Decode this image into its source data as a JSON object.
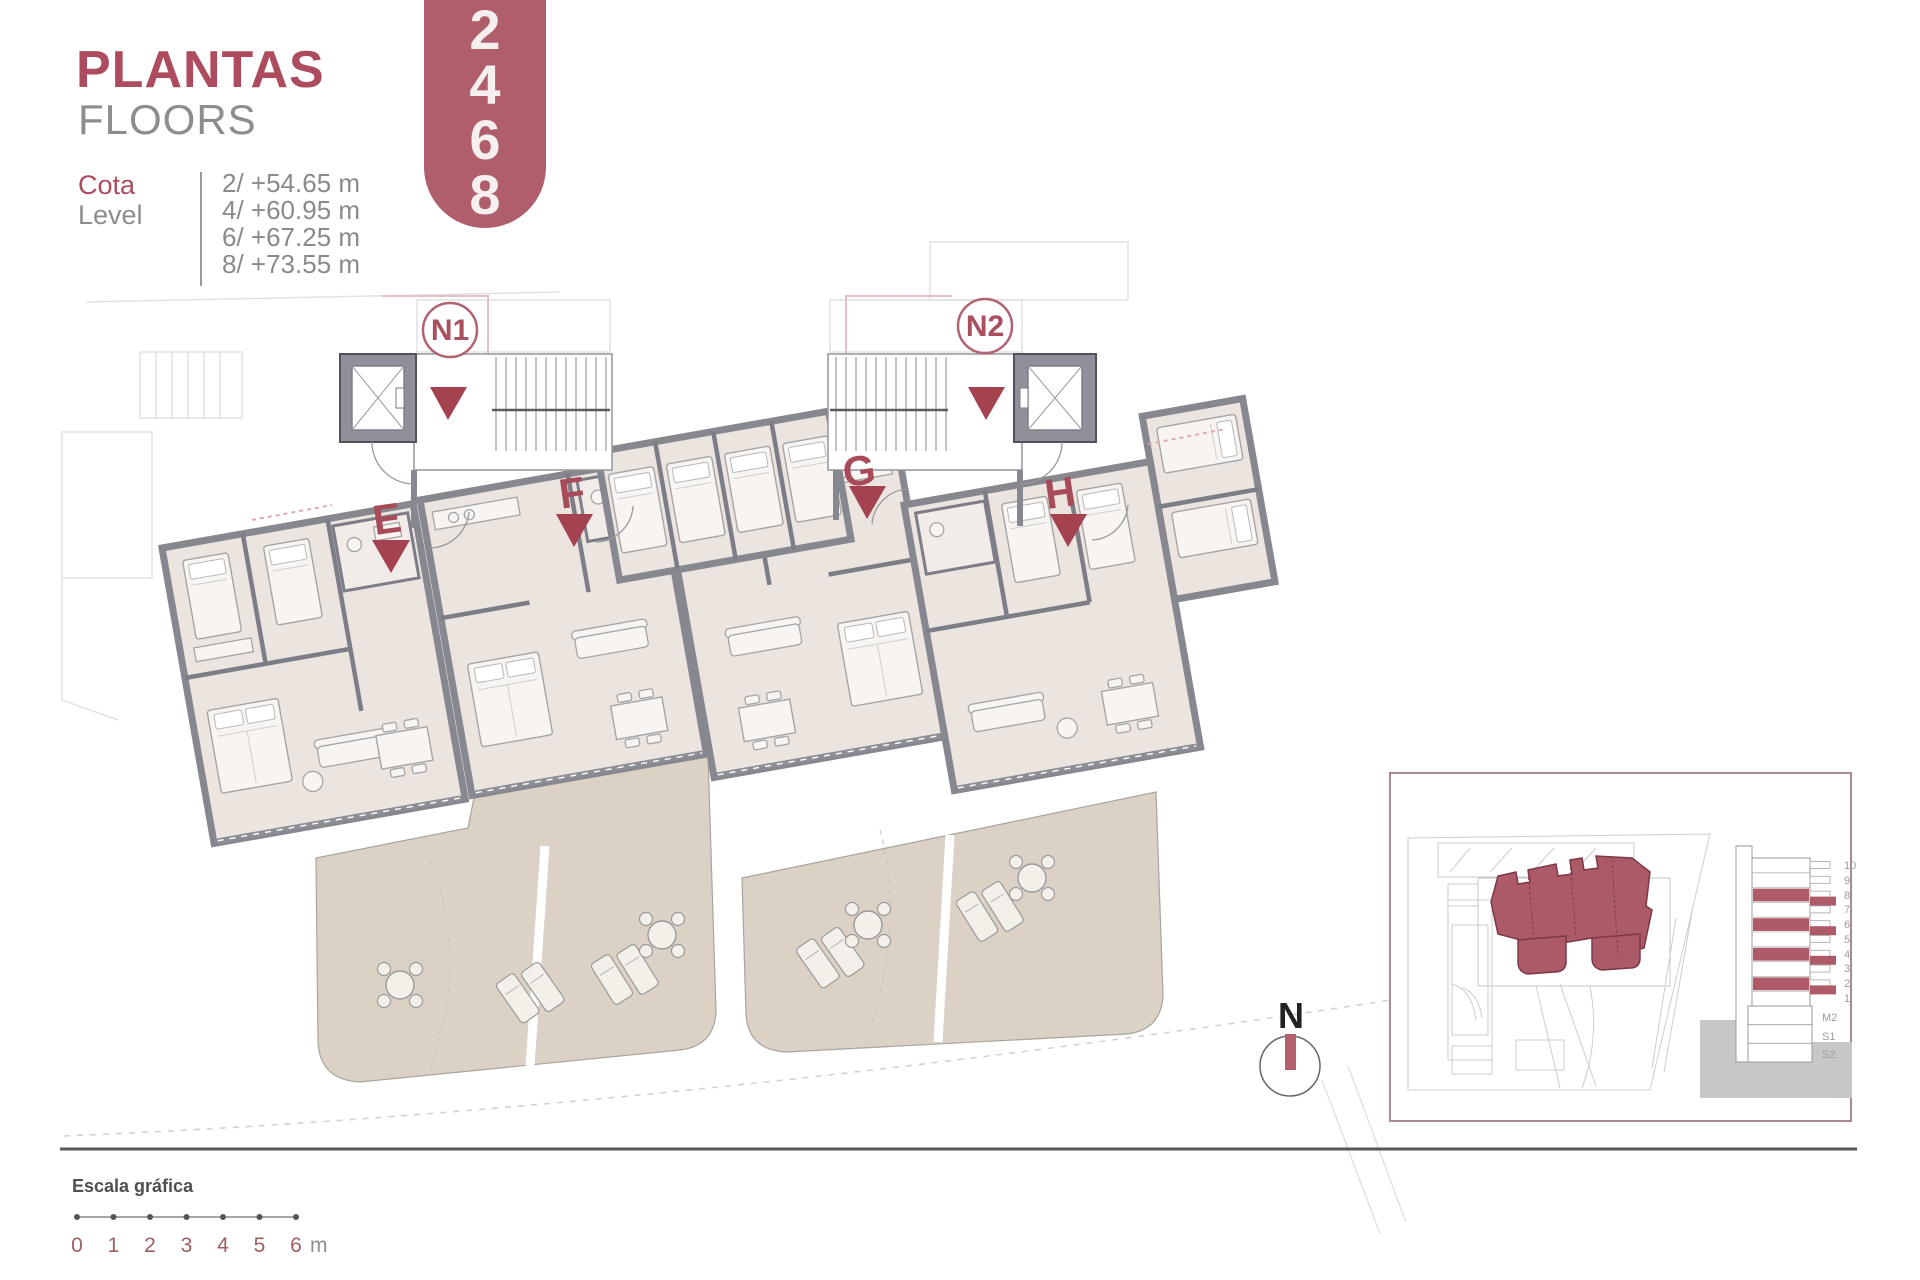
{
  "header": {
    "title": "PLANTAS",
    "subtitle": "FLOORS",
    "cota_label": "Cota",
    "level_label": "Level",
    "levels": [
      "2/ +54.65 m",
      "4/ +60.95 m",
      "6/ +67.25 m",
      "8/ +73.55 m"
    ],
    "banner_floors": [
      "2",
      "4",
      "6",
      "8"
    ]
  },
  "plan": {
    "cores": [
      {
        "label": "N1"
      },
      {
        "label": "N2"
      }
    ],
    "units": [
      {
        "label": "E"
      },
      {
        "label": "F"
      },
      {
        "label": "G"
      },
      {
        "label": "H"
      }
    ]
  },
  "compass": {
    "label": "N"
  },
  "inset": {
    "section_floors": [
      "10",
      "9",
      "8",
      "7",
      "6",
      "5",
      "4",
      "3",
      "2",
      "1",
      "M2",
      "S1",
      "S2"
    ],
    "highlighted_floors": [
      "8",
      "6",
      "4",
      "2"
    ]
  },
  "scale_bar": {
    "title": "Escala gráfica",
    "ticks": [
      "0",
      "1",
      "2",
      "3",
      "4",
      "5",
      "6"
    ],
    "unit": "m"
  },
  "colors": {
    "accent": "#a84b59",
    "banner": "#b05d6c",
    "arrow": "#a4424f",
    "footprint": "#ac5a67",
    "wall": "#87878f",
    "interior": "#ece4df",
    "terrace": "#dcd1c5"
  }
}
